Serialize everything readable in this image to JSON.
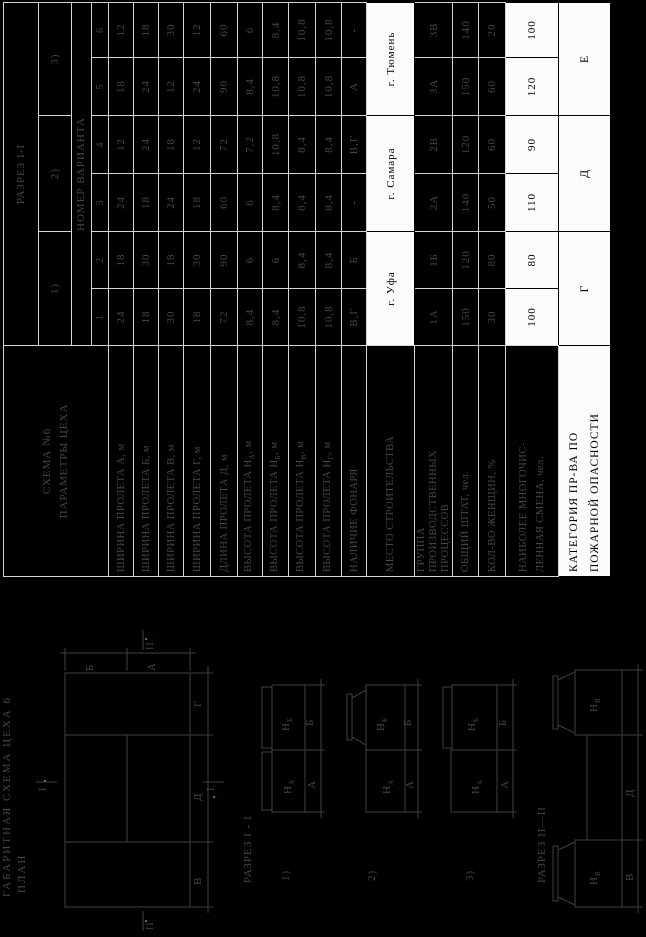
{
  "table": {
    "header": {
      "scheme_line1": "СХЕМА №6",
      "scheme_line2": "ПАРАМЕТРЫ ЦЕХА",
      "section_header": "РАЗРЕЗ I-I",
      "group_headers": [
        "1)",
        "2)",
        "3)"
      ],
      "variant_header": "НОМЕР ВАРИАНТА",
      "variant_numbers": [
        "1",
        "2",
        "3",
        "4",
        "5",
        "6"
      ]
    },
    "rows": [
      {
        "label_pre": "ШИРИНА ПРОЛЕТА А, м",
        "values": [
          "24",
          "18",
          "24",
          "12",
          "18",
          "12"
        ]
      },
      {
        "label_pre": "ШИРИНА ПРОЛЕТА Б, м",
        "values": [
          "18",
          "30",
          "18",
          "24",
          "24",
          "18"
        ]
      },
      {
        "label_pre": "ШИРИНА ПРОЛЕТА В, м",
        "values": [
          "30",
          "18",
          "24",
          "18",
          "12",
          "30"
        ]
      },
      {
        "label_pre": "ШИРИНА ПРОЛЕТА Г, м",
        "values": [
          "18",
          "30",
          "18",
          "12",
          "24",
          "12"
        ]
      },
      {
        "label_pre": "ДЛИНА ПРОЛЕТА Д, м",
        "values": [
          "72",
          "90",
          "60",
          "72",
          "90",
          "60"
        ]
      },
      {
        "label_pre": "ВЫСОТА ПРОЛЕТА Н",
        "label_sub": "А",
        "label_post": ", м",
        "values": [
          "8,4",
          "6",
          "6",
          "7,2",
          "8,4",
          "6"
        ]
      },
      {
        "label_pre": "ВЫСОТА ПРОЛЕТА Н",
        "label_sub": "Б",
        "label_post": ", м",
        "values": [
          "8,4",
          "6",
          "8,4",
          "10,8",
          "10,8",
          "8,4"
        ]
      },
      {
        "label_pre": "ВЫСОТА ПРОЛЕТА Н",
        "label_sub": "В",
        "label_post": ", м",
        "values": [
          "10,8",
          "8,4",
          "8,4",
          "8,4",
          "10,8",
          "10,8"
        ]
      },
      {
        "label_pre": "ВЫСОТА ПРОЛЕТА Н",
        "label_sub": "Г",
        "label_post": ", м",
        "values": [
          "10,8",
          "8,4",
          "8,4",
          "8,4",
          "10,8",
          "10,8"
        ]
      },
      {
        "label_pre": "НАЛИЧИЕ ФОНАРЯ",
        "values": [
          "В,Г",
          "Б",
          "-",
          "В,Г",
          "А",
          "-"
        ]
      }
    ],
    "place": {
      "label": "МЕСТО СТРОИТЕЛЬСТВА",
      "values": [
        "г. Уфа",
        "г. Самара",
        "г. Тюмень"
      ]
    },
    "group": {
      "label_lines": [
        "ГРУППА",
        "ПРОИЗВОДСТВЕННЫХ",
        "ПРОЦЕССОВ"
      ],
      "values": [
        "1А",
        "1Б",
        "2А",
        "2В",
        "3А",
        "3В"
      ]
    },
    "staff": {
      "label": "ОБЩИЙ ШТАТ, чел.",
      "values": [
        "150",
        "120",
        "140",
        "120",
        "150",
        "140"
      ]
    },
    "women": {
      "label": "КОЛ-ВО ЖЕНЩИН, %",
      "values": [
        "30",
        "80",
        "50",
        "60",
        "60",
        "20"
      ]
    },
    "shift": {
      "label_lines": [
        "НАИБОЛЕЕ МНОГОЧИС-",
        "ЛЕННАЯ СМЕНА, чел."
      ],
      "values": [
        "100",
        "80",
        "110",
        "90",
        "120",
        "100"
      ]
    },
    "category": {
      "label_lines": [
        "КАТЕГОРИЯ ПР-ВА ПО",
        "ПОЖАРНОЙ ОПАСНОСТИ"
      ],
      "values": [
        "Г",
        "Д",
        "Е"
      ]
    }
  },
  "drawings": {
    "title_line1": "ГАБАРИТНАЯ  СХЕМА  ЦЕХА 6",
    "title_line2": "ПЛАН",
    "plan": {
      "dim_b": "Б",
      "dim_a": "А",
      "dim_v": "В",
      "dim_d": "Д",
      "dim_g": "Г",
      "mark_i": "I",
      "mark_ii": "II"
    },
    "section1_label": "РАЗРЕЗ I - I",
    "section2_label": "РАЗРЕЗ II—II",
    "views": [
      {
        "num": "1)",
        "h_main": "Н",
        "h_left_sub": "А",
        "h_right_sub": "Б",
        "dim_left": "А",
        "dim_right": "Б"
      },
      {
        "num": "2)",
        "h_main": "Н",
        "h_left_sub": "А",
        "h_right_sub": "Б",
        "dim_left": "А",
        "dim_right": "Б"
      },
      {
        "num": "3)",
        "h_main": "Н",
        "h_left_sub": "А",
        "h_right_sub": "Б",
        "dim_left": "А",
        "dim_right": "Б"
      }
    ],
    "section2": {
      "h_main": "Н",
      "h_left_sub": "В",
      "h_right_sub": "В",
      "dim_left": "В",
      "dim_mid": "Д",
      "dim_right": "Г"
    }
  }
}
